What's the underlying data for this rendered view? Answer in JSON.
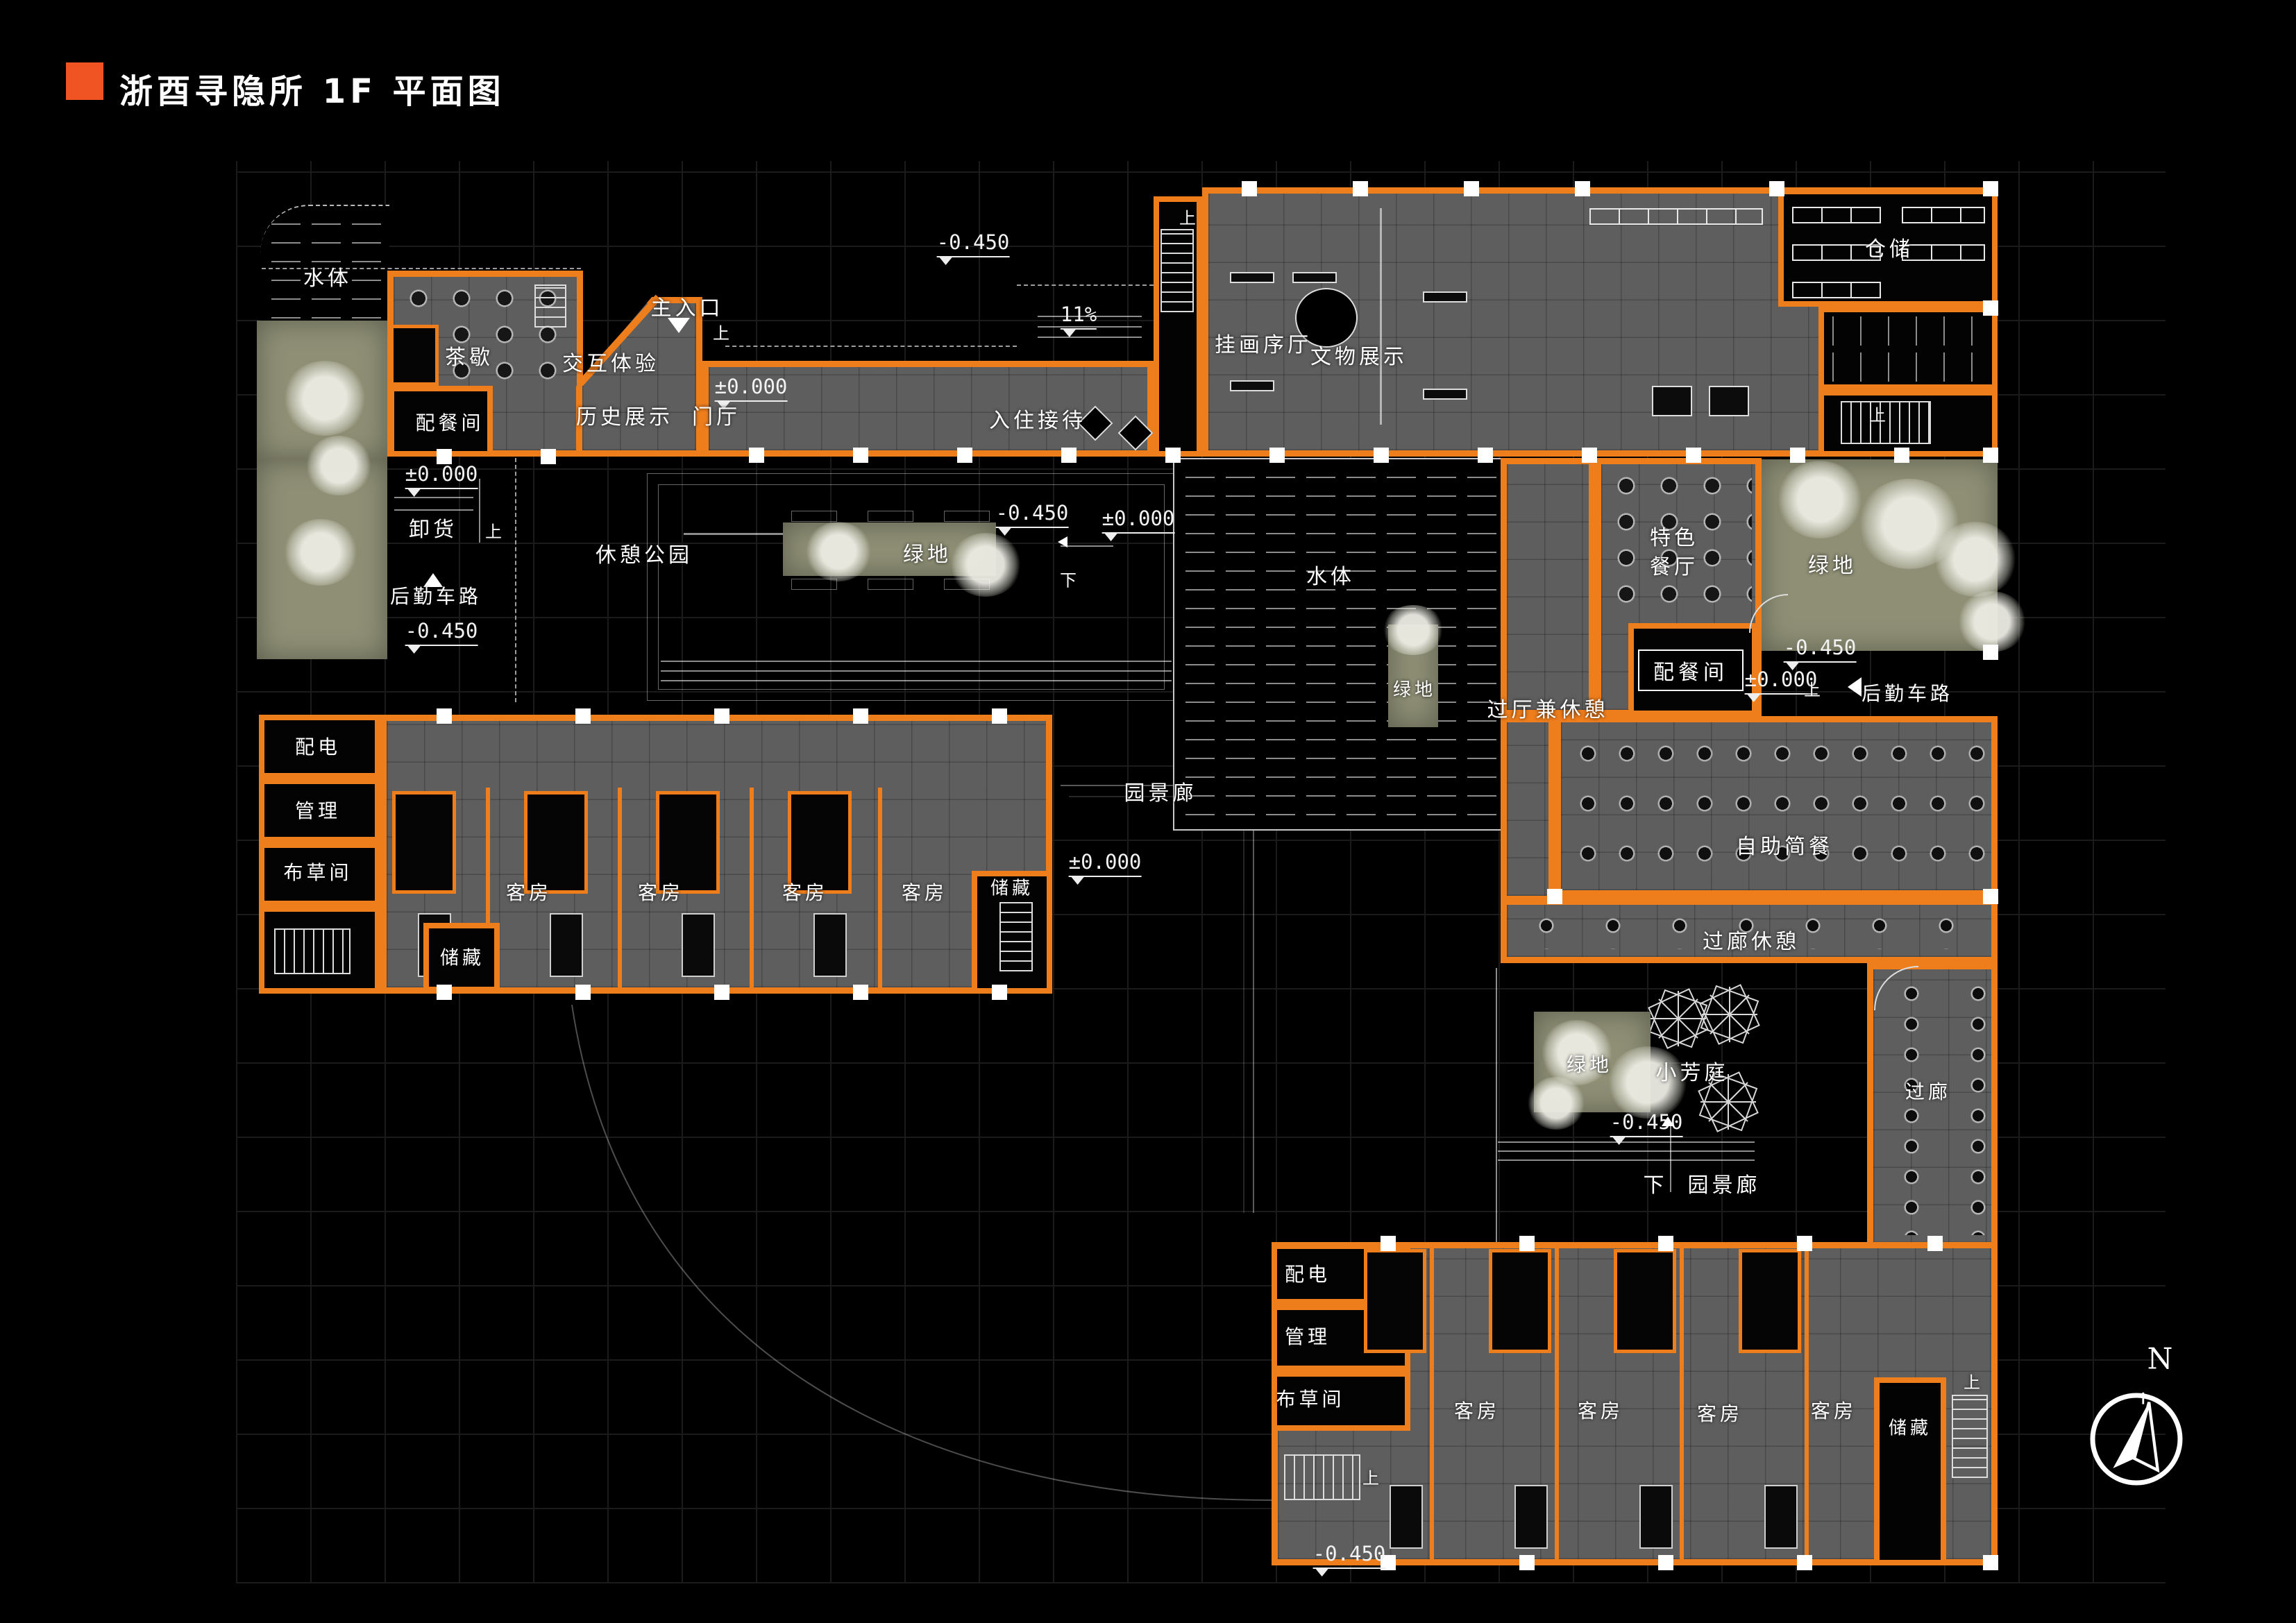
{
  "header": {
    "title": "浙酉寻隐所 1F 平面图"
  },
  "compass": {
    "north": "N"
  },
  "levels": {
    "zero": "±0.000",
    "minus": "-0.450",
    "ramp_slope": "11%"
  },
  "nav": {
    "up": "上",
    "down": "下"
  },
  "labels": {
    "water": "水体",
    "tea_break": "茶歇",
    "pantry": "配餐间",
    "interactive_exp": "交互体验",
    "history_display": "历史展示",
    "main_entrance": "主入口",
    "foyer": "门厅",
    "checkin": "入住接待",
    "painting_hall": "挂画序厅",
    "artifact_display": "文物展示",
    "warehouse": "仓储",
    "unloading": "卸货",
    "service_road": "后勤车路",
    "rest_park": "休憩公园",
    "green": "绿地",
    "hall_rest": "过厅兼休憩",
    "special_restaurant_line1": "特色",
    "special_restaurant_line2": "餐厅",
    "buffet": "自助简餐",
    "corridor_rest": "过廊休憩",
    "garden_gallery": "园景廊",
    "power_room": "配电",
    "management": "管理",
    "linen_room": "布草间",
    "storage": "储藏",
    "guest_room": "客房",
    "small_court": "小芳庭",
    "passage": "过廊"
  },
  "colors": {
    "wall_orange": "#ee7d1c",
    "title_orange": "#f05423",
    "floor_gray": "#5e5e5e",
    "landscape_green": "#8e8f75",
    "background": "#000000"
  }
}
